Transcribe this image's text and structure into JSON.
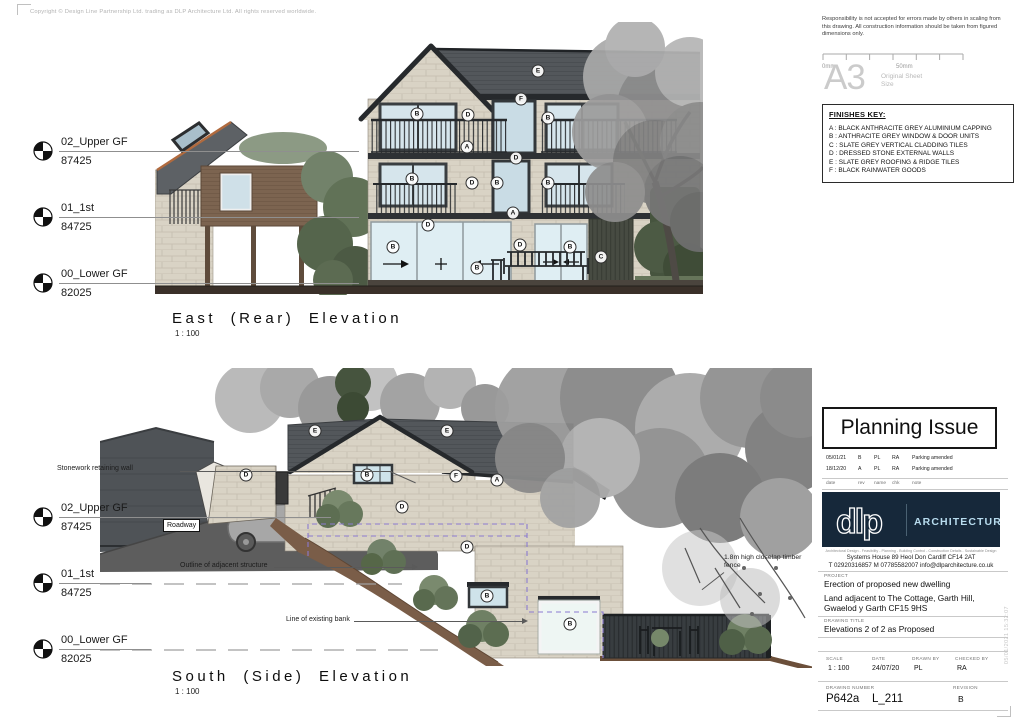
{
  "page": {
    "copyright": "Copyright © Design Line Partnership Ltd. trading as DLP Architecture Ltd. All rights reserved worldwide.",
    "plot_stamp": "05/01/2021 15:32:07"
  },
  "disclaimer": "Responsibility is not accepted for errors made by others in scaling from this drawing.  All construction information should be taken from figured dimensions only.",
  "scale_bar": {
    "start": "0mm",
    "end": "50mm"
  },
  "sheet_size": {
    "size": "A3",
    "label_line1": "Original Sheet",
    "label_line2": "Size"
  },
  "finishes_key": {
    "title": "FINISHES KEY:",
    "items": [
      "A : BLACK ANTHRACITE GREY ALUMINIUM CAPPING",
      "B : ANTHRACITE GREY WINDOW & DOOR UNITS",
      "C : SLATE GREY VERTICAL CLADDING TILES",
      "D : DRESSED STONE EXTERNAL WALLS",
      "E : SLATE GREY ROOFING & RIDGE TILES",
      "F : BLACK RAINWATER GOODS"
    ]
  },
  "planning_issue": "Planning Issue",
  "revisions": {
    "headers": {
      "date": "date",
      "rev": "rev",
      "name": "name",
      "chk": "chk",
      "note": "note"
    },
    "rows": [
      {
        "date": "05/01/21",
        "rev": "B",
        "name": "PL",
        "chk": "RA",
        "note": "Parking amended"
      },
      {
        "date": "18/12/20",
        "rev": "A",
        "name": "PL",
        "chk": "RA",
        "note": "Parking amended"
      }
    ]
  },
  "logo": {
    "mark": "dlp",
    "word": "ARCHITECTURE",
    "services": "Architectural Design - Feasibility - Planning - Building Control - Construction Details - Sustainable Design",
    "address": "Systems House    89 Heol Don    Cardiff    CF14 2AT",
    "contact": "T  02920316857    M  07785582007    info@dlparchitecture.co.uk"
  },
  "project": {
    "label": "PROJECT",
    "line1": "Erection of proposed new dwelling",
    "line2": "Land adjacent to The Cottage, Garth Hill,",
    "line3": "Gwaelod y Garth CF15 9HS"
  },
  "drawing_title": {
    "label": "DRAWING TITLE",
    "value": "Elevations 2 of 2 as Proposed"
  },
  "title_block": {
    "scale_label": "SCALE",
    "scale": "1 : 100",
    "date_label": "DATE",
    "date": "24/07/20",
    "drawn_label": "DRAWN BY",
    "drawn": "PL",
    "checked_label": "CHECKED BY",
    "checked": "RA",
    "number_label": "DRAWING NUMBER",
    "number": "P642a",
    "number2": "L_211",
    "revision_label": "REVISION",
    "revision": "B"
  },
  "levels": {
    "items": [
      {
        "label": "02_Upper GF",
        "value": "87425"
      },
      {
        "label": "01_1st",
        "value": "84725"
      },
      {
        "label": "00_Lower GF",
        "value": "82025"
      }
    ]
  },
  "east": {
    "title": "East (Rear) Elevation",
    "scale": "1 : 100",
    "tags": [
      {
        "t": "E",
        "x": 383,
        "y": 49
      },
      {
        "t": "F",
        "x": 366,
        "y": 77
      },
      {
        "t": "B",
        "x": 262,
        "y": 92
      },
      {
        "t": "D",
        "x": 313,
        "y": 93
      },
      {
        "t": "B",
        "x": 393,
        "y": 96
      },
      {
        "t": "A",
        "x": 312,
        "y": 125
      },
      {
        "t": "D",
        "x": 361,
        "y": 136
      },
      {
        "t": "B",
        "x": 257,
        "y": 157
      },
      {
        "t": "D",
        "x": 317,
        "y": 161
      },
      {
        "t": "B",
        "x": 342,
        "y": 161
      },
      {
        "t": "B",
        "x": 393,
        "y": 161
      },
      {
        "t": "A",
        "x": 358,
        "y": 191
      },
      {
        "t": "D",
        "x": 273,
        "y": 203
      },
      {
        "t": "B",
        "x": 238,
        "y": 225
      },
      {
        "t": "D",
        "x": 365,
        "y": 223
      },
      {
        "t": "B",
        "x": 415,
        "y": 225
      },
      {
        "t": "B",
        "x": 322,
        "y": 246
      },
      {
        "t": "C",
        "x": 446,
        "y": 235
      }
    ]
  },
  "south": {
    "title": "South (Side) Elevation",
    "scale": "1 : 100",
    "tags": [
      {
        "t": "D",
        "x": 146,
        "y": 107
      },
      {
        "t": "E",
        "x": 215,
        "y": 63
      },
      {
        "t": "E",
        "x": 347,
        "y": 63
      },
      {
        "t": "B",
        "x": 267,
        "y": 107
      },
      {
        "t": "F",
        "x": 356,
        "y": 108
      },
      {
        "t": "A",
        "x": 397,
        "y": 112
      },
      {
        "t": "D",
        "x": 302,
        "y": 139
      },
      {
        "t": "D",
        "x": 367,
        "y": 179
      },
      {
        "t": "B",
        "x": 387,
        "y": 228
      },
      {
        "t": "B",
        "x": 470,
        "y": 256
      }
    ],
    "annotations": {
      "stonework": "Stonework retaining wall",
      "roadway": "Roadway",
      "outline": "Outline of adjacent structure",
      "bank": "Line of existing bank",
      "fence": "1.8m high closelap timber fence"
    }
  }
}
